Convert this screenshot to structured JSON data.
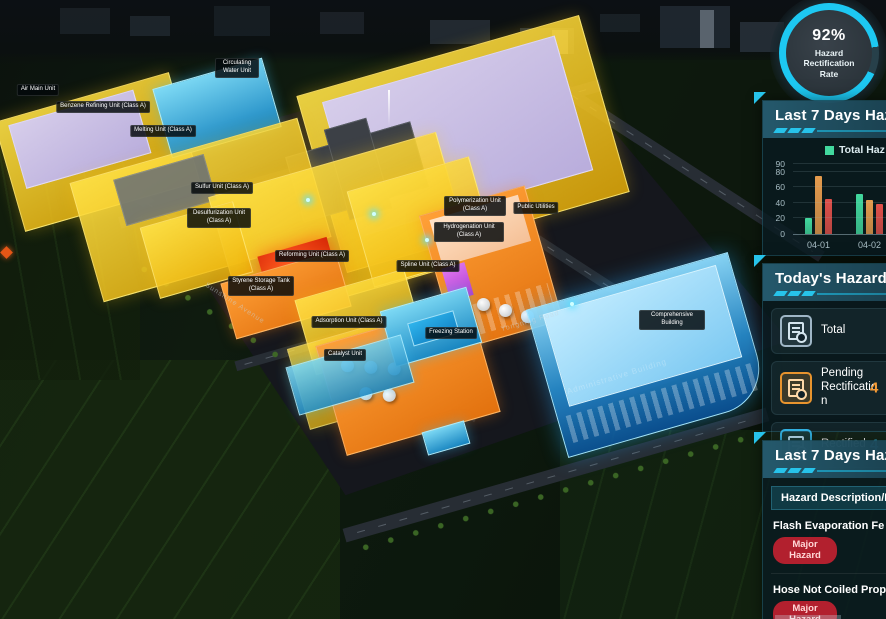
{
  "hud": {
    "gauge": {
      "value": "92%",
      "label": "Hazard Rectification Rate"
    },
    "trend_panel": {
      "title": "Last 7 Days Haza",
      "legend_label": "Total Haz"
    },
    "today_panel": {
      "title": "Today's Hazard S",
      "rows": [
        {
          "label": "Total",
          "value": ""
        },
        {
          "label": "Pending Rectification",
          "value": "4"
        },
        {
          "label": "Rectified",
          "value": "4"
        }
      ]
    },
    "list_panel": {
      "title": "Last 7 Days Haza",
      "column_header": "Hazard Description/L",
      "rows": [
        {
          "name": "Flash Evaporation Fe",
          "badge": "Major Hazard"
        },
        {
          "name": "Hose Not Coiled Prop",
          "badge": "Major Hazard"
        }
      ]
    }
  },
  "chart_data": {
    "type": "bar",
    "title": "Last 7 Days Haza",
    "categories": [
      "04-01",
      "04-02"
    ],
    "series": [
      {
        "name": "Total Haz",
        "color": "#42d89e",
        "values": [
          20,
          52
        ]
      },
      {
        "name": "",
        "color": "#e59b4d",
        "values": [
          75,
          44
        ]
      },
      {
        "name": "",
        "color": "#e0504a",
        "values": [
          45,
          39
        ]
      }
    ],
    "ylim": [
      0,
      90
    ],
    "yticks": [
      0,
      20,
      40,
      60,
      80,
      90
    ],
    "xlabel": "",
    "ylabel": "",
    "grid": true,
    "legend_position": "top"
  },
  "map": {
    "labels": [
      {
        "text": "Circulating Water Unit"
      },
      {
        "text": "Air Main Unit"
      },
      {
        "text": "Benzene Refining Unit (Class A)"
      },
      {
        "text": "Melting Unit (Class A)"
      },
      {
        "text": "Sulfur Unit (Class A)"
      },
      {
        "text": "Desulfurization Unit (Class A)"
      },
      {
        "text": "Reforming Unit (Class A)"
      },
      {
        "text": "Styrene Storage Tank (Class A)"
      },
      {
        "text": "Spline Unit (Class A)"
      },
      {
        "text": "Adsorption Unit (Class A)"
      },
      {
        "text": "Catalyst Unit"
      },
      {
        "text": "Freezing Station"
      },
      {
        "text": "Polymerization Unit (Class A)"
      },
      {
        "text": "Public Utilities"
      },
      {
        "text": "Hydrogenation Unit (Class A)"
      },
      {
        "text": "Comprehensive Building"
      }
    ],
    "road_labels": [
      {
        "text": "Sunshine Avenue"
      },
      {
        "text": "Yongning Road"
      }
    ],
    "watermark": "Administrative Building"
  },
  "colors": {
    "accent_cyan": "#27c3ea",
    "gauge_ring": "#1dc8f2",
    "bar_green": "#42d89e",
    "bar_orange": "#e59b4d",
    "bar_red": "#e0504a",
    "badge_red": "#b2202e",
    "pending_orange": "#f59a35",
    "rectified_blue": "#3cc3f2"
  }
}
